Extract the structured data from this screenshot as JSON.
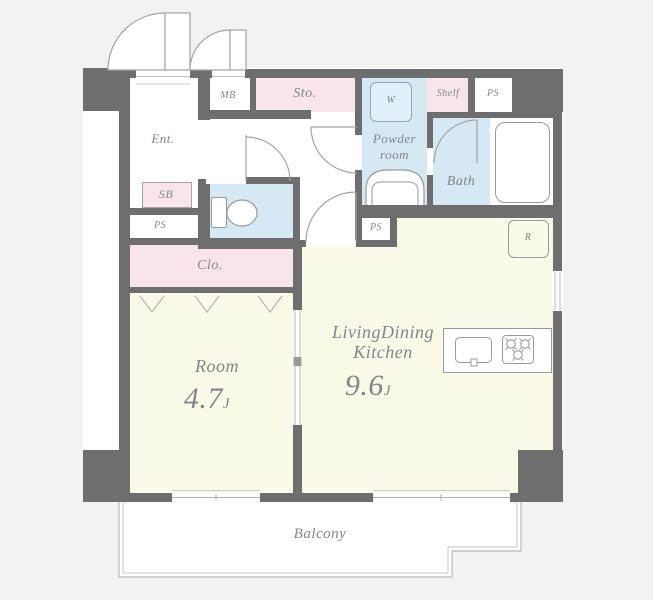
{
  "title": "1LDK apartment floor plan",
  "colors": {
    "background": "#f2f2f2",
    "wall": "#6e6e6e",
    "room_floor": "#fbf9e7",
    "wet_area_blue": "#d5e8f4",
    "storage_pink": "#fae4eb",
    "linework": "#a3a3a3",
    "text": "#83868b"
  },
  "labels": {
    "entrance": "Ent.",
    "meter_box": "MB",
    "storage": "Sto.",
    "washer": "W",
    "shelf": "Shelf",
    "pipe_space_top": "PS",
    "powder_line1": "Powder",
    "powder_line2": "room",
    "bath": "Bath",
    "shoe_box": "SB",
    "pipe_space_left": "PS",
    "closet": "Clo.",
    "pipe_space_mid": "PS",
    "refrigerator": "R",
    "balcony": "Balcony"
  },
  "rooms": {
    "bedroom": {
      "name": "Room",
      "size": "4.7",
      "unit": "J"
    },
    "ldk": {
      "name_line1": "LivingDining",
      "name_line2": "Kitchen",
      "size": "9.6",
      "unit": "J"
    }
  }
}
